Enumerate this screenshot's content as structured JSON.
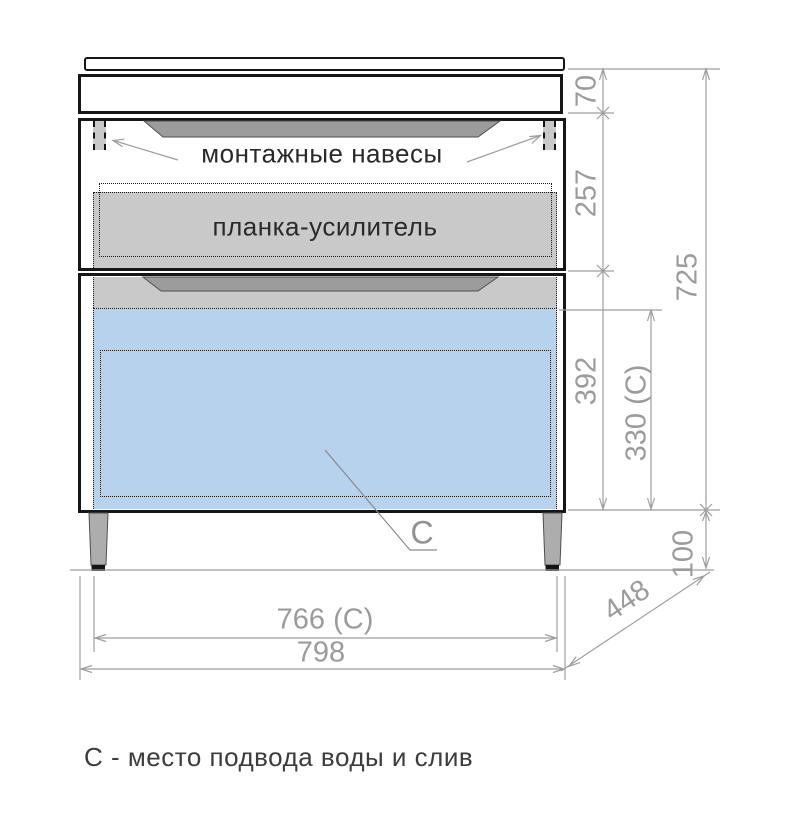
{
  "drawing": {
    "labels": {
      "mounting_hangers": "монтажные навесы",
      "reinforcement_plank": "планка-усилитель",
      "c_marker": "С",
      "caption": "С - место подвода воды и слив"
    },
    "dimensions": {
      "countertop_height": "70",
      "upper_section_height": "257",
      "lower_section_height": "392",
      "drain_zone_height": "330 (С)",
      "body_height": "725",
      "legs_height": "100",
      "depth": "448",
      "drain_zone_width": "766 (С)",
      "overall_width": "798"
    },
    "colors": {
      "outline": "#161616",
      "dimension_gray": "#9b9b9b",
      "panel_gray": "#c9c9c9",
      "handle_gray": "#9c9c9c",
      "drain_blue": "#b7d2ec",
      "leg_gray": "#adadad"
    }
  }
}
